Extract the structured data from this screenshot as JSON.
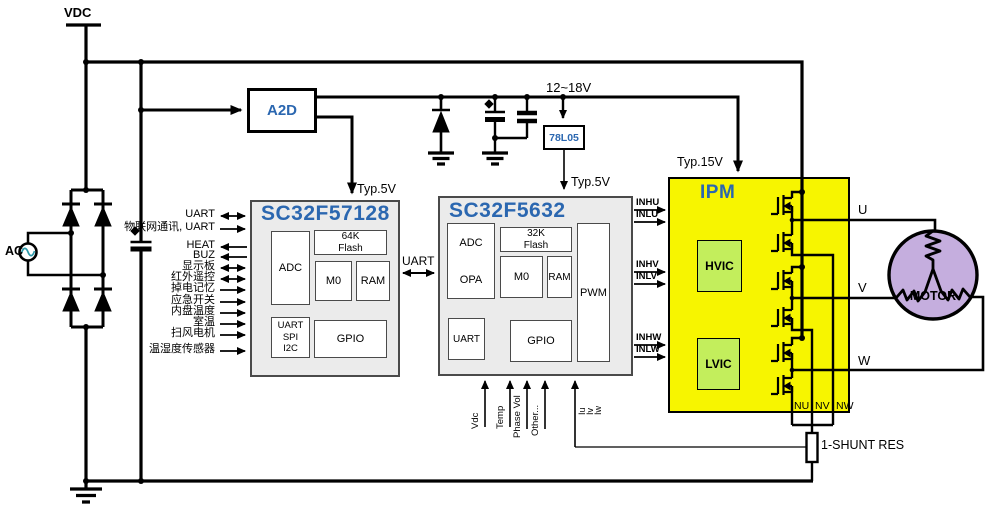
{
  "labels": {
    "vdc": "VDC",
    "ac": "AC",
    "bus_voltage": "12~18V",
    "regulator": "78L05",
    "typ5_mcu1": "Typ.5V",
    "typ5_mcu2": "Typ.5V",
    "typ15": "Typ.15V",
    "a2d": "A2D",
    "uart_link": "UART",
    "shunt": "1-SHUNT\nRES",
    "motor": "MOTOR",
    "phase_u": "U",
    "phase_v": "V",
    "phase_w": "W"
  },
  "colors": {
    "accent_blue": "#2b67b0",
    "ipm_yellow": "#f7f500",
    "ic_green": "#c3ee5c",
    "motor_purple": "#c5aede",
    "block_gray": "#ebebeb"
  },
  "mcu1": {
    "title": "SC32F57128",
    "blocks": {
      "adc": "ADC",
      "flash": "64K\nFlash",
      "m0": "M0",
      "ram": "RAM",
      "comms": "UART\nSPI\nI2C",
      "gpio": "GPIO"
    },
    "signals": [
      {
        "label": "UART",
        "dir": "both"
      },
      {
        "label": "物联网通讯, UART",
        "dir": "in"
      },
      {
        "label": "HEAT",
        "dir": "out"
      },
      {
        "label": "BUZ",
        "dir": "out"
      },
      {
        "label": "显示板",
        "dir": "both"
      },
      {
        "label": "红外遥控",
        "dir": "both"
      },
      {
        "label": "掉电记忆",
        "dir": "in"
      },
      {
        "label": "应急开关",
        "dir": "in"
      },
      {
        "label": "内盘温度",
        "dir": "in"
      },
      {
        "label": "室温",
        "dir": "in"
      },
      {
        "label": "扫风电机",
        "dir": "in"
      },
      {
        "label": "温湿度传感器",
        "dir": "in"
      }
    ]
  },
  "mcu2": {
    "title": "SC32F5632",
    "blocks": {
      "adc": "ADC",
      "opa": "OPA",
      "flash": "32K\nFlash",
      "m0": "M0",
      "ram": "RAM",
      "pwm": "PWM",
      "uart": "UART",
      "gpio": "GPIO"
    },
    "pwm_outputs": [
      "INHU",
      "INLU",
      "INHV",
      "INLV",
      "INHW",
      "INLW"
    ],
    "analog_inputs": [
      "Vdc",
      "Temp",
      "Phase Vol",
      "Other..."
    ],
    "current_inputs": [
      "Iu",
      "Iv",
      "Iw"
    ]
  },
  "ipm": {
    "title": "IPM",
    "hvic": "HVIC",
    "lvic": "LVIC",
    "n_pins": [
      "NU",
      "NV",
      "NW"
    ]
  }
}
